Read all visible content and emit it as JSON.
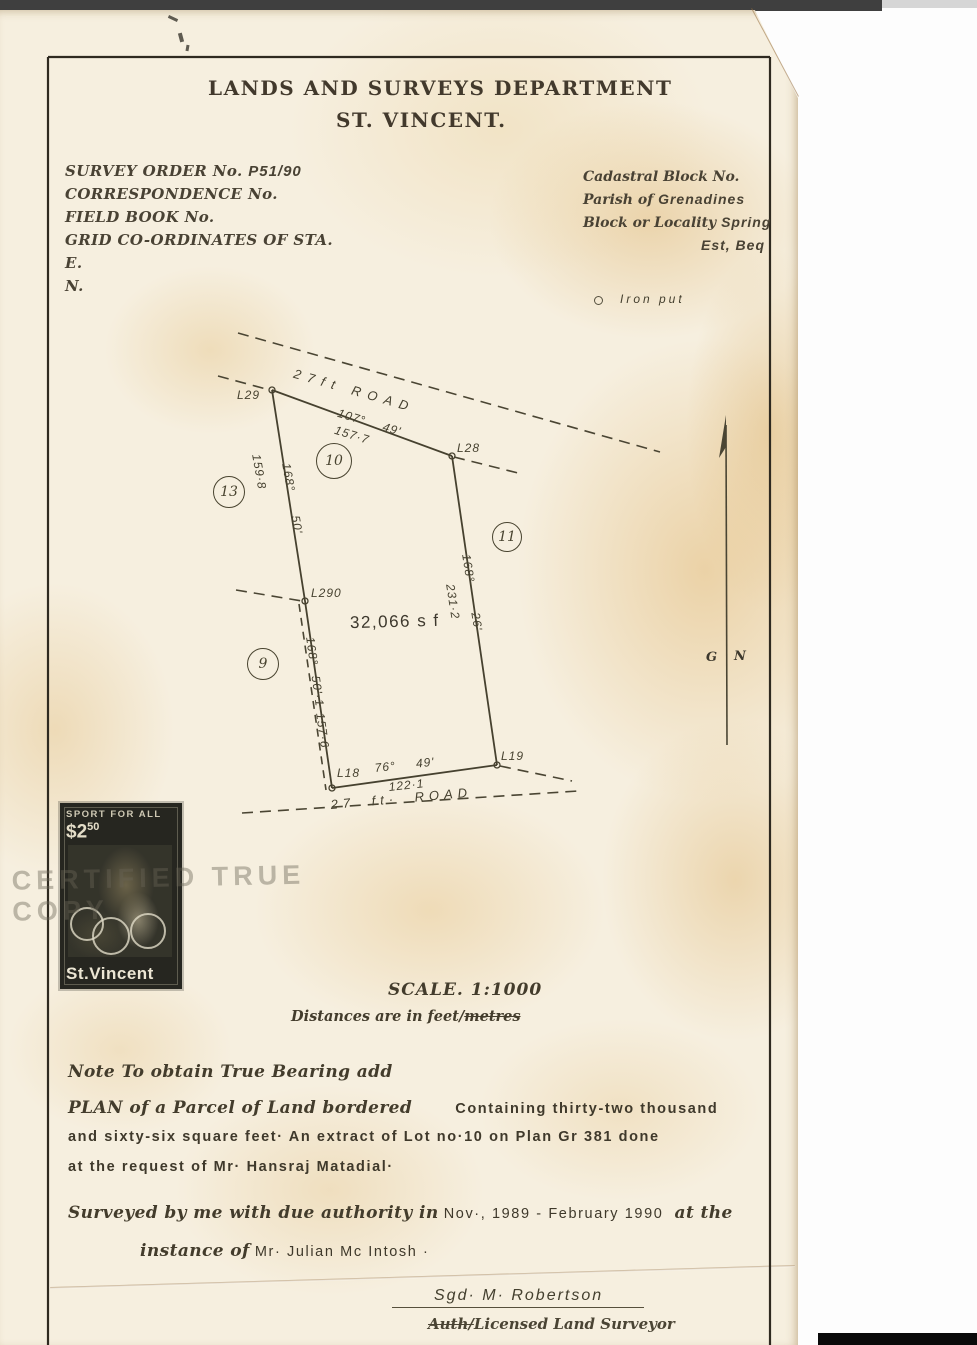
{
  "colors": {
    "paper": "#f6efdf",
    "ink": "#3d382d",
    "stain": "#e0b978"
  },
  "header": {
    "line1": "LANDS AND SURVEYS DEPARTMENT",
    "line2": "ST. VINCENT."
  },
  "info_left": {
    "l1_label": "SURVEY ORDER No.",
    "l1_value": "P51/90",
    "l2": "CORRESPONDENCE No.",
    "l3": "FIELD BOOK No.",
    "l4": "GRID CO-ORDINATES OF STA.",
    "l5": "E.",
    "l6": "N."
  },
  "info_right": {
    "r1": "Cadastral Block No.",
    "r2_label": "Parish of",
    "r2_value": "Grenadines",
    "r3_label": "Block or Locality",
    "r3_value": "Spring",
    "r4": "Est, Beq"
  },
  "legend": {
    "iron_pin_label": "Iron put"
  },
  "plan": {
    "top_road_label": "27ft ROAD",
    "bottom_road_label": "27 ft· ROAD",
    "area_label": "32,066 s f",
    "corner_labels": {
      "l29": "L29",
      "l28": "L28",
      "l290": "L290",
      "l18": "L18",
      "l19": "L19"
    },
    "lot_labels": {
      "lot10": "10",
      "lot13": "13",
      "lot11": "11",
      "lot9": "9"
    },
    "boundaries": {
      "top": {
        "bearing": "107° 49'",
        "distance": "157·7"
      },
      "right": {
        "bearing": "168° 26'",
        "distance": "231·2"
      },
      "upper_left": {
        "bearing": "168° 50'",
        "distance": "159·8"
      },
      "lower_left": {
        "bearing": "168° 50'·1",
        "distance": "157·6"
      },
      "bottom": {
        "bearing": "76° 49'",
        "distance": "122·1"
      }
    },
    "north_arrow": {
      "g": "G",
      "n": "N"
    }
  },
  "stamp": {
    "header": "SPORT FOR ALL",
    "denomination": "$2",
    "denomination_cents": "50",
    "country": "St.Vincent"
  },
  "overprint": "CERTIFIED TRUE COPY",
  "scale_block": {
    "scale": "SCALE. 1:1000",
    "distances_prefix": "Distances are in feet/",
    "distances_struck": "metres"
  },
  "notes": {
    "true_bearing": "Note To obtain True Bearing add",
    "plan_line1_serif": "PLAN of a Parcel of Land bordered",
    "plan_line1_sans": "Containing thirty-two thousand",
    "plan_line2": "and sixty-six square feet·  An extract of Lot no·10 on Plan Gr 381 done",
    "plan_line3": "at the request of Mr· Hansraj Matadial·",
    "surveyed_serif": "Surveyed by me with due authority in",
    "surveyed_sans": "Nov·, 1989 - February 1990",
    "surveyed_tail": "at the",
    "instance_serif": "instance of",
    "instance_sans": "Mr· Julian  Mc Intosh ·"
  },
  "signature": {
    "signed": "Sgd·  M· Robertson",
    "role_struck": "Auth/",
    "role": "Licensed Land Surveyor"
  }
}
